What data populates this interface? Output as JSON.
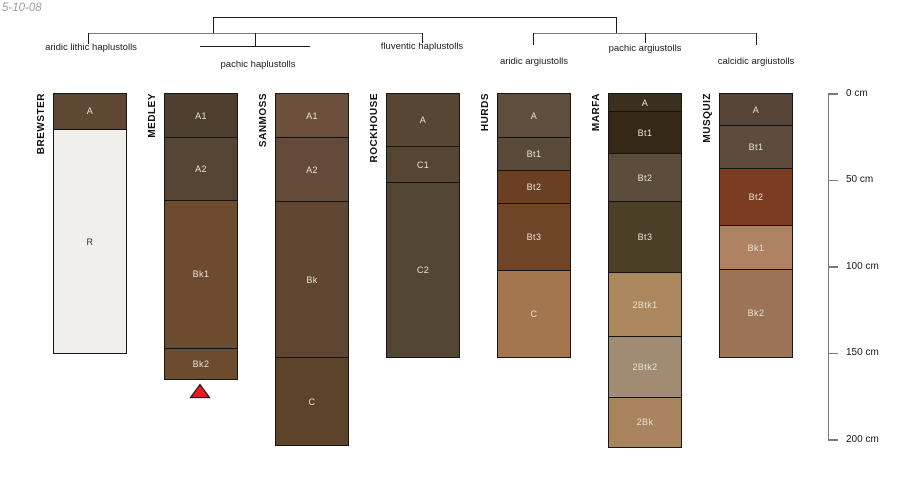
{
  "figure": {
    "date_label": "5-10-08"
  },
  "classification_tree": {
    "labels": [
      "aridic lithic haplustolls",
      "pachic haplustolls",
      "fluventic haplustolls",
      "aridic argiustolls",
      "pachic argiustolls",
      "calcidic argiustolls"
    ]
  },
  "depth_axis": {
    "unit": "cm",
    "tick_labels": [
      "0 cm",
      "50 cm",
      "100 cm",
      "150 cm",
      "200 cm"
    ],
    "tick_values_cm": [
      0,
      50,
      100,
      150,
      200
    ],
    "range_cm": [
      0,
      200
    ]
  },
  "chart_data": {
    "type": "soil-profile-column-chart",
    "ylabel": "depth below surface (cm)",
    "depth_range_cm": [
      0,
      200
    ],
    "series": [
      {
        "name": "BREWSTER",
        "classification": "aridic lithic haplustolls",
        "horizons": [
          {
            "label": "A",
            "top_cm": 0,
            "bottom_cm": 20,
            "color": "#5e4733"
          },
          {
            "label": "R",
            "top_cm": 20,
            "bottom_cm": 150,
            "color": "#f0efec"
          }
        ]
      },
      {
        "name": "MEDLEY",
        "classification": "pachic haplustolls",
        "continues_deeper_marker": {
          "shape": "triangle-up",
          "color": "#ea1c22"
        },
        "horizons": [
          {
            "label": "A1",
            "top_cm": 0,
            "bottom_cm": 25,
            "color": "#4e3e2e"
          },
          {
            "label": "A2",
            "top_cm": 25,
            "bottom_cm": 61,
            "color": "#564534"
          },
          {
            "label": "Bk1",
            "top_cm": 61,
            "bottom_cm": 147,
            "color": "#6c4b2f"
          },
          {
            "label": "Bk2",
            "top_cm": 147,
            "bottom_cm": 165,
            "color": "#6c4b2f"
          }
        ]
      },
      {
        "name": "SANMOSS",
        "classification": "pachic haplustolls",
        "horizons": [
          {
            "label": "A1",
            "top_cm": 0,
            "bottom_cm": 25,
            "color": "#6d503c"
          },
          {
            "label": "A2",
            "top_cm": 25,
            "bottom_cm": 62,
            "color": "#644b39"
          },
          {
            "label": "Bk",
            "top_cm": 62,
            "bottom_cm": 152,
            "color": "#604631"
          },
          {
            "label": "C",
            "top_cm": 152,
            "bottom_cm": 203,
            "color": "#5e432b"
          }
        ]
      },
      {
        "name": "ROCKHOUSE",
        "classification": "fluventic haplustolls",
        "horizons": [
          {
            "label": "A",
            "top_cm": 0,
            "bottom_cm": 30,
            "color": "#574634"
          },
          {
            "label": "C1",
            "top_cm": 30,
            "bottom_cm": 51,
            "color": "#564533"
          },
          {
            "label": "C2",
            "top_cm": 51,
            "bottom_cm": 152,
            "color": "#544634"
          }
        ]
      },
      {
        "name": "HURDS",
        "classification": "aridic argiustolls",
        "horizons": [
          {
            "label": "A",
            "top_cm": 0,
            "bottom_cm": 25,
            "color": "#5f4e3d"
          },
          {
            "label": "Bt1",
            "top_cm": 25,
            "bottom_cm": 44,
            "color": "#594a3a"
          },
          {
            "label": "Bt2",
            "top_cm": 44,
            "bottom_cm": 63,
            "color": "#6a3f24"
          },
          {
            "label": "Bt3",
            "top_cm": 63,
            "bottom_cm": 102,
            "color": "#6f4527"
          },
          {
            "label": "C",
            "top_cm": 102,
            "bottom_cm": 152,
            "color": "#a3764f"
          }
        ]
      },
      {
        "name": "MARFA",
        "classification": "pachic argiustolls",
        "horizons": [
          {
            "label": "A",
            "top_cm": 0,
            "bottom_cm": 10,
            "color": "#3b2f20"
          },
          {
            "label": "Bt1",
            "top_cm": 10,
            "bottom_cm": 34,
            "color": "#352817"
          },
          {
            "label": "Bt2",
            "top_cm": 34,
            "bottom_cm": 62,
            "color": "#5b4c3b"
          },
          {
            "label": "Bt3",
            "top_cm": 62,
            "bottom_cm": 103,
            "color": "#4c3f27"
          },
          {
            "label": "2Btk1",
            "top_cm": 103,
            "bottom_cm": 140,
            "color": "#ab865f"
          },
          {
            "label": "2Btk2",
            "top_cm": 140,
            "bottom_cm": 175,
            "color": "#a18b73"
          },
          {
            "label": "2Bk",
            "top_cm": 175,
            "bottom_cm": 204,
            "color": "#a9845e"
          }
        ]
      },
      {
        "name": "MUSQUIZ",
        "classification": "calcidic argiustolls",
        "horizons": [
          {
            "label": "A",
            "top_cm": 0,
            "bottom_cm": 18,
            "color": "#564438"
          },
          {
            "label": "Bt1",
            "top_cm": 18,
            "bottom_cm": 43,
            "color": "#5f4b3d"
          },
          {
            "label": "Bt2",
            "top_cm": 43,
            "bottom_cm": 76,
            "color": "#7b3c21"
          },
          {
            "label": "Bk1",
            "top_cm": 76,
            "bottom_cm": 101,
            "color": "#af8264"
          },
          {
            "label": "Bk2",
            "top_cm": 101,
            "bottom_cm": 152,
            "color": "#9d7357"
          }
        ]
      }
    ]
  }
}
